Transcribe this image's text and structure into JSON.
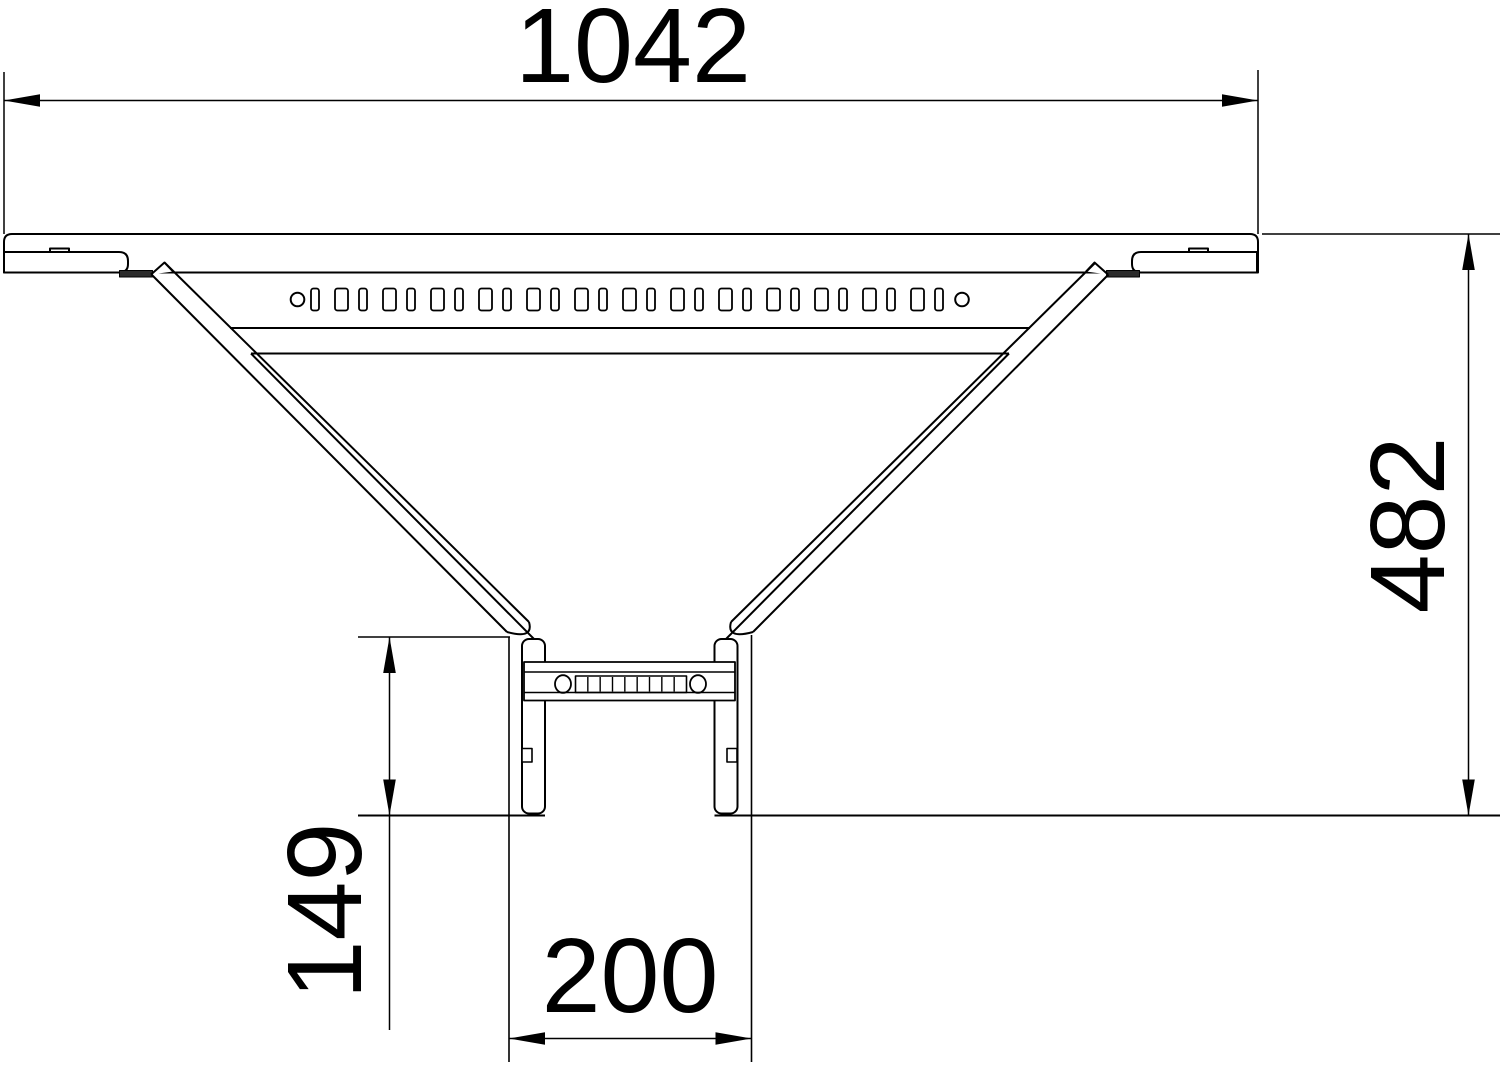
{
  "drawing": {
    "kind": "technical-dimension-drawing",
    "subject": "cable-ladder add-on tee, plan view",
    "dimensions": {
      "overall_width": "1042",
      "overall_depth": "482",
      "branch_stub_length": "149",
      "branch_width": "200"
    },
    "colors": {
      "line": "#000000",
      "background": "#ffffff",
      "clamp_fill": "#2b2b2b"
    }
  }
}
